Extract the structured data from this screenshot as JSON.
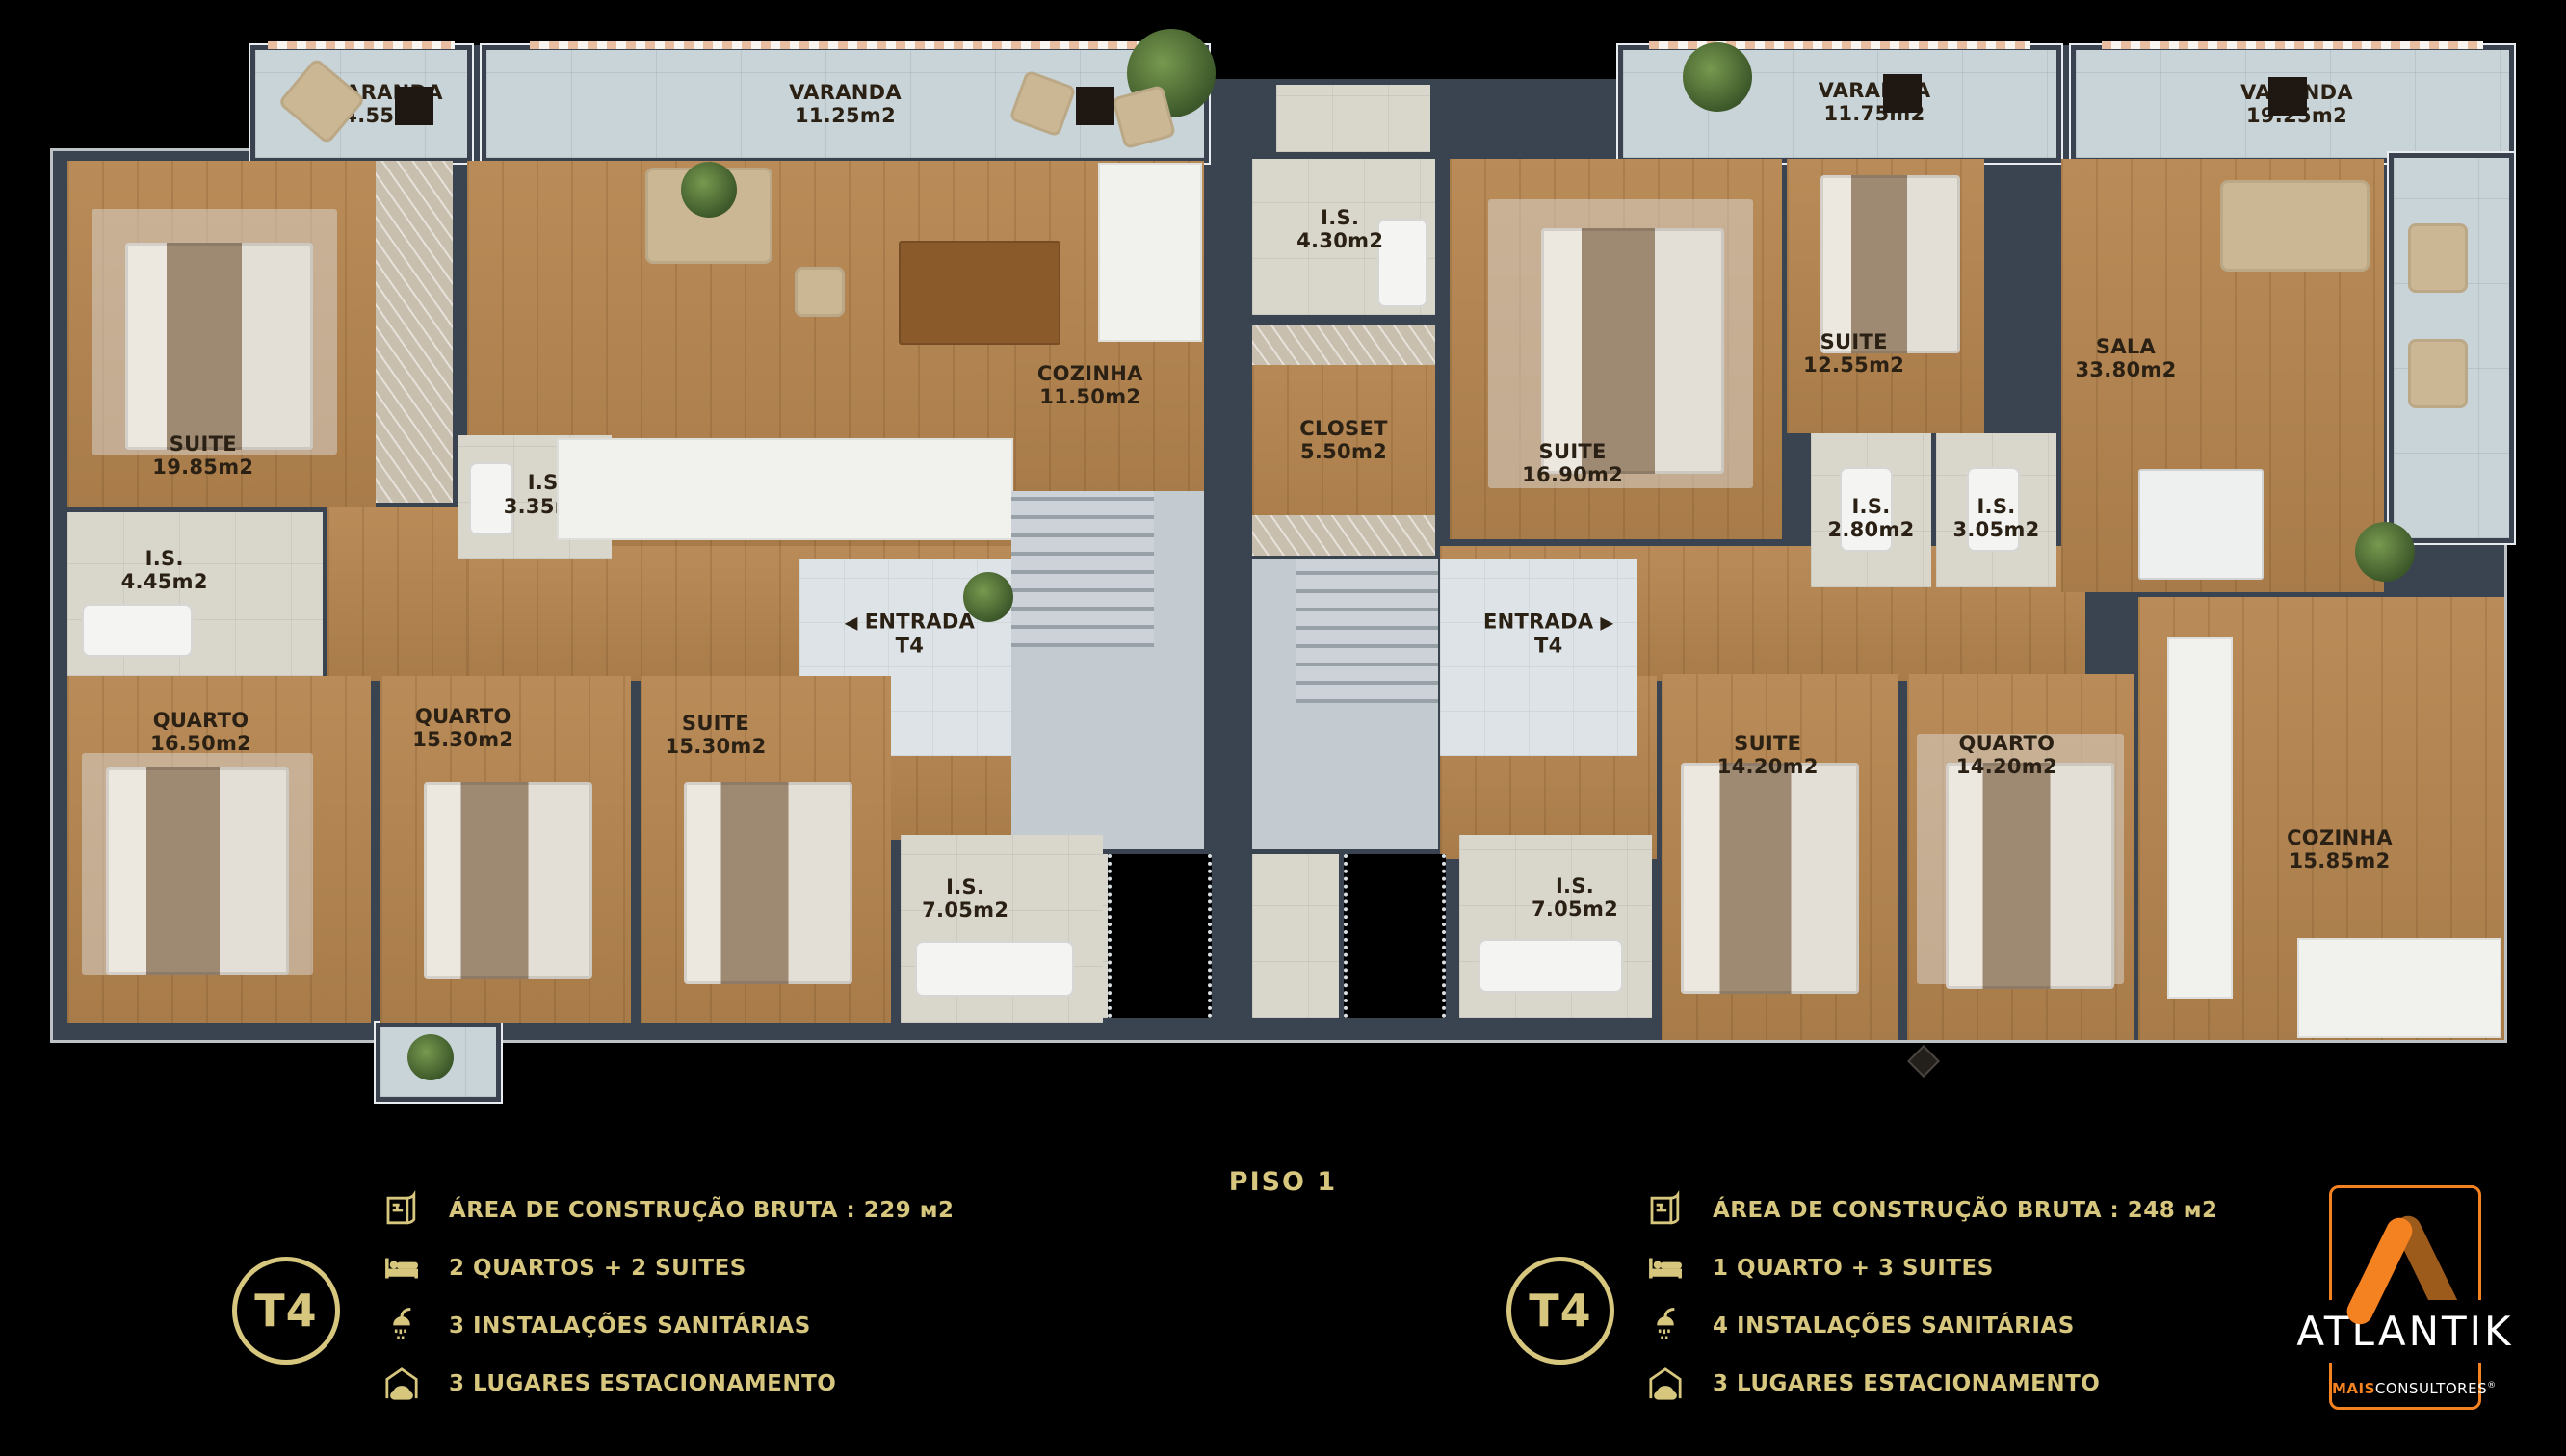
{
  "colors": {
    "background": "#000000",
    "wall": "#3a4450",
    "wood_floor": "#b5854f",
    "terrace_tile": "#c9d4d8",
    "bathroom_tile": "#d9d6cc",
    "legend_gold": "#d7c67d",
    "logo_orange": "#f58220",
    "logo_brown": "#9c5a1b"
  },
  "plan": {
    "varandas": {
      "v1": {
        "name": "VARANDA",
        "area": "4.55m2"
      },
      "v2": {
        "name": "VARANDA",
        "area": "11.25m2"
      },
      "v3": {
        "name": "VARANDA",
        "area": "11.75m2"
      },
      "v4": {
        "name": "VARANDA",
        "area": "19.25m2"
      }
    },
    "left_unit": {
      "suite1": {
        "name": "SUITE",
        "area": "19.85m2"
      },
      "is1": {
        "name": "I.S.",
        "area": "4.45m2"
      },
      "is2": {
        "name": "I.S.",
        "area": "3.35m2"
      },
      "sala": {
        "name": "SALA",
        "area": "36.95m2"
      },
      "cozinha": {
        "name": "COZINHA",
        "area": "11.50m2"
      },
      "entrada": {
        "arrow": "◀",
        "name": "ENTRADA",
        "sub": "T4"
      },
      "quarto1": {
        "name": "QUARTO",
        "area": "16.50m2"
      },
      "quarto2": {
        "name": "QUARTO",
        "area": "15.30m2"
      },
      "suite2": {
        "name": "SUITE",
        "area": "15.30m2"
      },
      "is3": {
        "name": "I.S.",
        "area": "7.05m2"
      }
    },
    "right_unit": {
      "is1": {
        "name": "I.S.",
        "area": "4.30m2"
      },
      "closet": {
        "name": "CLOSET",
        "area": "5.50m2"
      },
      "suite1": {
        "name": "SUITE",
        "area": "16.90m2"
      },
      "suite2": {
        "name": "SUITE",
        "area": "12.55m2"
      },
      "is2": {
        "name": "I.S.",
        "area": "2.80m2"
      },
      "is3": {
        "name": "I.S.",
        "area": "3.05m2"
      },
      "sala": {
        "name": "SALA",
        "area": "33.80m2"
      },
      "entrada": {
        "name": "ENTRADA",
        "sub": "T4",
        "arrow": "▶"
      },
      "is4": {
        "name": "I.S.",
        "area": "7.05m2"
      },
      "suite3": {
        "name": "SUITE",
        "area": "14.20m2"
      },
      "quarto": {
        "name": "QUARTO",
        "area": "14.20m2"
      },
      "cozinha": {
        "name": "COZINHA",
        "area": "15.85m2"
      }
    }
  },
  "footer": {
    "piso_label": "PISO 1",
    "legend_left": {
      "tag": "T4",
      "rows": [
        {
          "icon": "blueprint-icon",
          "text": "ÁREA DE CONSTRUÇÃO BRUTA :  229 м2"
        },
        {
          "icon": "bed-icon",
          "text": "2 QUARTOS + 2 SUITES"
        },
        {
          "icon": "shower-icon",
          "text": "3 INSTALAÇÕES SANITÁRIAS"
        },
        {
          "icon": "garage-icon",
          "text": "3 LUGARES ESTACIONAMENTO"
        }
      ]
    },
    "legend_right": {
      "tag": "T4",
      "rows": [
        {
          "icon": "blueprint-icon",
          "text": "ÁREA DE CONSTRUÇÃO BRUTA :  248 м2"
        },
        {
          "icon": "bed-icon",
          "text": "1 QUARTO + 3 SUITES"
        },
        {
          "icon": "shower-icon",
          "text": "4 INSTALAÇÕES SANITÁRIAS"
        },
        {
          "icon": "garage-icon",
          "text": "3 LUGARES ESTACIONAMENTO"
        }
      ]
    }
  },
  "logo": {
    "brand": "ATLANTIK",
    "sub_bold": "MAIS",
    "sub_rest": "CONSULTORES",
    "reg": "®"
  }
}
